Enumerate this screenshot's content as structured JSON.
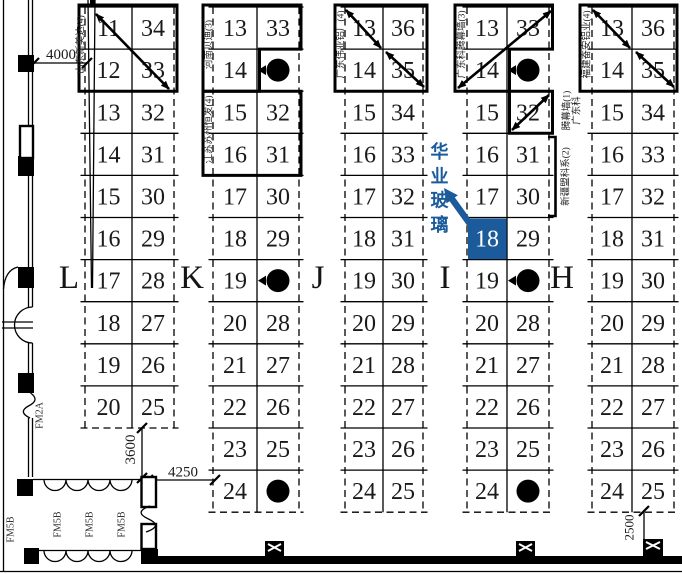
{
  "plan": {
    "accent_color": "#1b5b9b",
    "highlight": {
      "group": "I",
      "booth": "18",
      "company": "华业玻璃"
    },
    "groups": [
      {
        "name": "L",
        "rows": [
          [
            "11",
            "34"
          ],
          [
            "12",
            "33"
          ],
          [
            "13",
            "32"
          ],
          [
            "14",
            "31"
          ],
          [
            "15",
            "30"
          ],
          [
            "16",
            "29"
          ],
          [
            "17",
            "28"
          ],
          [
            "18",
            "27"
          ],
          [
            "19",
            "26"
          ],
          [
            "20",
            "25"
          ]
        ],
        "companies": [
          {
            "label": "山东新美达(4)"
          }
        ]
      },
      {
        "name": "K",
        "rows": [
          [
            "13",
            "33"
          ],
          [
            "14",
            null
          ],
          [
            "15",
            "32"
          ],
          [
            "16",
            "31"
          ],
          [
            "17",
            "30"
          ],
          [
            "18",
            "29"
          ],
          [
            "19",
            null
          ],
          [
            "20",
            "28"
          ],
          [
            "21",
            "27"
          ],
          [
            "22",
            "26"
          ],
          [
            "23",
            "25"
          ],
          [
            "24",
            null
          ]
        ],
        "companies": [
          {
            "label": "河南贝迪(3)"
          },
          {
            "label": "江苏苏州恒发(4)"
          }
        ]
      },
      {
        "name": "J",
        "rows": [
          [
            "13",
            "36"
          ],
          [
            "14",
            "35"
          ],
          [
            "15",
            "34"
          ],
          [
            "16",
            "33"
          ],
          [
            "17",
            "32"
          ],
          [
            "18",
            "31"
          ],
          [
            "19",
            "30"
          ],
          [
            "20",
            "29"
          ],
          [
            "21",
            "28"
          ],
          [
            "22",
            "27"
          ],
          [
            "23",
            "26"
          ],
          [
            "24",
            "25"
          ]
        ],
        "companies": [
          {
            "label": "广东伟业铝厂(4)"
          }
        ]
      },
      {
        "name": "I",
        "rows": [
          [
            "13",
            "33"
          ],
          [
            "14",
            null
          ],
          [
            "15",
            "32"
          ],
          [
            "16",
            "31"
          ],
          [
            "17",
            "30"
          ],
          [
            "18",
            "29"
          ],
          [
            "19",
            null
          ],
          [
            "20",
            "28"
          ],
          [
            "21",
            "27"
          ],
          [
            "22",
            "26"
          ],
          [
            "23",
            "25"
          ],
          [
            "24",
            null
          ]
        ],
        "highlight": {
          "row": 5,
          "col": 0
        },
        "companies": [
          {
            "label": "广东科腾幕墙(3)"
          },
          {
            "label": "广东科腾幕墙(1)",
            "lines": [
              "广东科",
              "腾幕墙(1)"
            ]
          },
          {
            "label": "新疆盟科系(2)"
          }
        ]
      },
      {
        "name": "H",
        "rows": [
          [
            "13",
            "36"
          ],
          [
            "14",
            "35"
          ],
          [
            "15",
            "34"
          ],
          [
            "16",
            "33"
          ],
          [
            "17",
            "32"
          ],
          [
            "18",
            "31"
          ],
          [
            "19",
            "30"
          ],
          [
            "20",
            "29"
          ],
          [
            "21",
            "28"
          ],
          [
            "22",
            "27"
          ],
          [
            "23",
            "26"
          ],
          [
            "24",
            "25"
          ]
        ],
        "companies": [
          {
            "label": "福建奋安铝业(4)"
          }
        ]
      }
    ],
    "dimensions": [
      {
        "text": "4000"
      },
      {
        "text": "3600"
      },
      {
        "text": "4250"
      },
      {
        "text": "2500"
      }
    ],
    "door_tags": [
      {
        "text": "FM2A"
      },
      {
        "text": "FM5B"
      },
      {
        "text": "FM5B"
      },
      {
        "text": "FM5B"
      },
      {
        "text": "FM5B"
      }
    ]
  }
}
